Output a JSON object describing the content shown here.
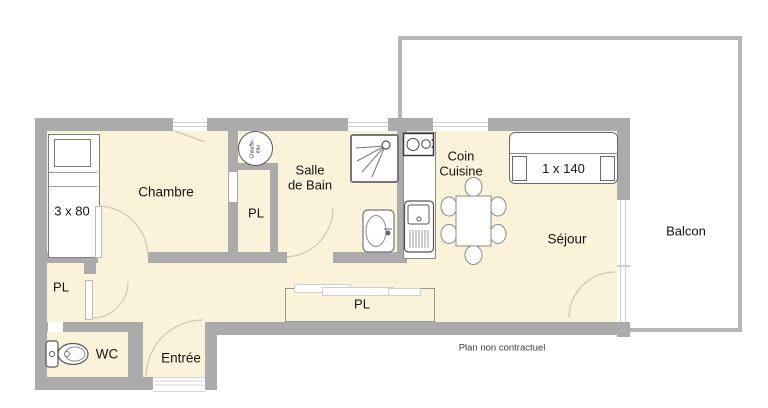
{
  "labels": {
    "chambre": "Chambre",
    "pl_closet": "PL",
    "salle_de_bain": "Salle\nde Bain",
    "coin_cuisine": "Coin\nCuisine",
    "sejour": "Séjour",
    "balcon": "Balcon",
    "wc": "WC",
    "entree": "Entrée",
    "pl_hall": "PL",
    "pl_corridor": "PL",
    "bed_size": "3 x 80",
    "sofa_size": "1 x 140",
    "water_heater": "Chauffe-\neau",
    "disclaimer": "Plan non contractuel"
  },
  "colors": {
    "floor": "#faf2d9",
    "wall": "#ababab",
    "text": "#141414",
    "balcony_border": "#b5b5b5",
    "arc": "#cfc8b4"
  }
}
